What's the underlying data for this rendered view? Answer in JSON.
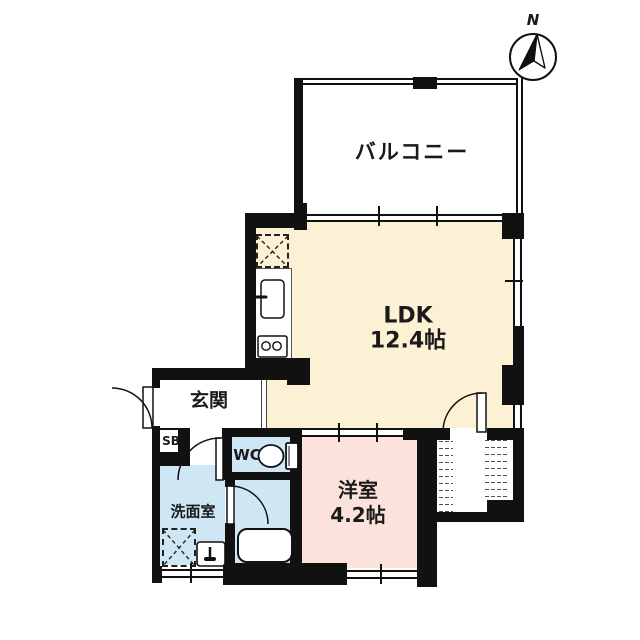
{
  "compass": {
    "label": "N"
  },
  "rooms": {
    "balcony": {
      "label": "バルコニー"
    },
    "ldk": {
      "label": "LDK",
      "size": "12.4帖"
    },
    "entrance": {
      "label": "玄関"
    },
    "shoe_box": {
      "label": "SB"
    },
    "wc": {
      "label": "WC"
    },
    "washroom": {
      "label": "洗面室"
    },
    "western_room": {
      "label": "洋室",
      "size": "4.2帖"
    }
  },
  "colors": {
    "wall": "#111111",
    "plan_bg": "#ffffff",
    "ldk_fill": "#fcf0d5",
    "western_fill": "#fbe3dc",
    "wet_fill": "#cfe7f5"
  }
}
